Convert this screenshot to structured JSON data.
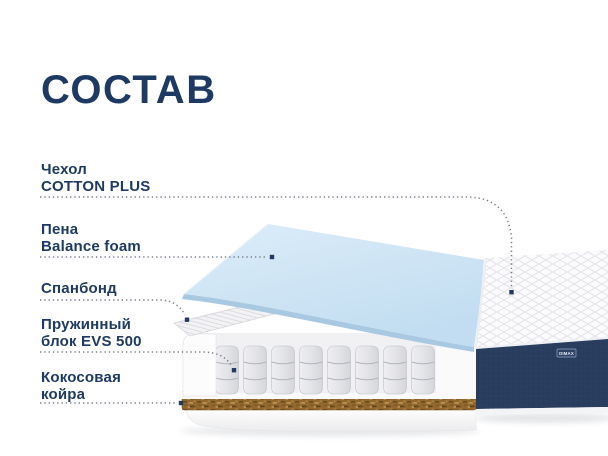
{
  "title": "СОСТАВ",
  "brand_badge": "DIMAX",
  "layers": [
    {
      "name": "cover",
      "lines": [
        "Чехол",
        "COTTON PLUS"
      ]
    },
    {
      "name": "foam",
      "lines": [
        "Пена",
        "Balance foam"
      ]
    },
    {
      "name": "spunbond",
      "lines": [
        "Спанбонд"
      ]
    },
    {
      "name": "springs",
      "lines": [
        "Пружинный",
        "блок EVS 500"
      ]
    },
    {
      "name": "coir",
      "lines": [
        "Кокосовая",
        "койра"
      ]
    }
  ],
  "colors": {
    "accent_navy": "#1e3a63",
    "leader_grey": "#767f8b",
    "foam_blue_light": "#dcedf9",
    "foam_blue": "#c2ddf1",
    "foam_blue_deep": "#a9c9e3",
    "quilt_line": "#e3e3e7",
    "fabric_navy": "#293d5f",
    "fabric_navy_light": "#34496e",
    "coir_brown": "#93682f",
    "coir_dark": "#6b4a1e",
    "coir_light": "#c09a55",
    "pocket_grey_light": "#efeff2",
    "pocket_grey": "#d5d6da",
    "seam_grey": "#b3b5bc"
  }
}
